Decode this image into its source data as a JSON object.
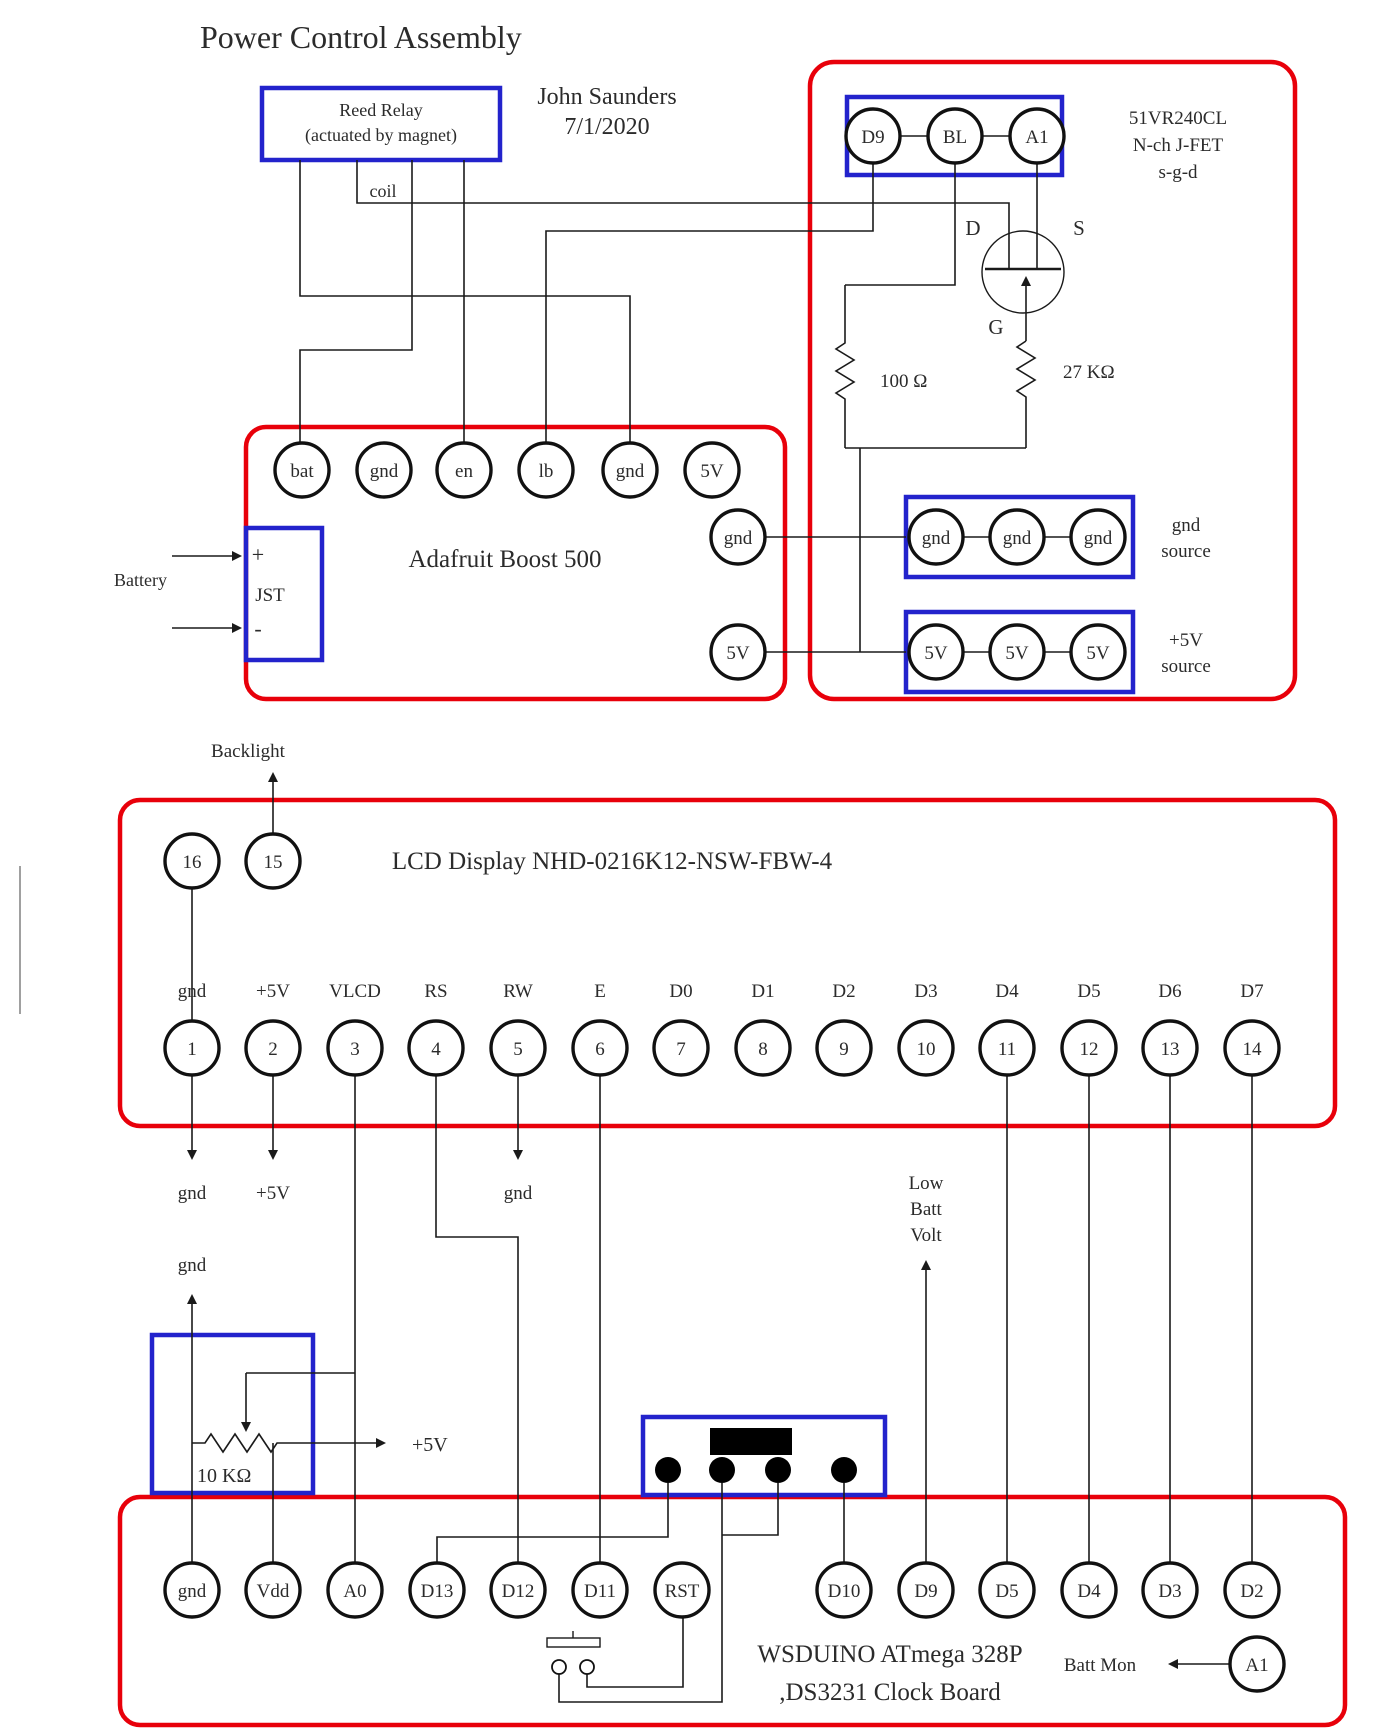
{
  "title": "Power Control Assembly",
  "author": {
    "name": "John Saunders",
    "date": "7/1/2020"
  },
  "relay": {
    "line1": "Reed Relay",
    "line2": "(actuated by magnet)",
    "coil": "coil"
  },
  "fet": {
    "header": {
      "pins": [
        "D9",
        "BL",
        "A1"
      ]
    },
    "part": "51VR240CL",
    "type": "N-ch J-FET",
    "pinout": "s-g-d",
    "d": "D",
    "s": "S",
    "g": "G",
    "r_gate": "27 KΩ",
    "r_bl": "100 Ω"
  },
  "boost": {
    "name": "Adafruit Boost 500",
    "top_pins": [
      "bat",
      "gnd",
      "en",
      "lb",
      "gnd",
      "5V"
    ],
    "right_pins": [
      "gnd",
      "5V"
    ],
    "jst": {
      "label": "JST",
      "plus": "+",
      "minus": "-"
    },
    "battery": "Battery"
  },
  "sources": {
    "gnd": {
      "pins": [
        "gnd",
        "gnd",
        "gnd"
      ],
      "label1": "gnd",
      "label2": "source"
    },
    "v5": {
      "pins": [
        "5V",
        "5V",
        "5V"
      ],
      "label1": "+5V",
      "label2": "source"
    }
  },
  "lcd": {
    "name": "LCD Display NHD-0216K12-NSW-FBW-4",
    "backlight": "Backlight",
    "top_pins": [
      "16",
      "15"
    ],
    "signals": [
      "gnd",
      "+5V",
      "VLCD",
      "RS",
      "RW",
      "E",
      "D0",
      "D1",
      "D2",
      "D3",
      "D4",
      "D5",
      "D6",
      "D7"
    ],
    "numbers": [
      "1",
      "2",
      "3",
      "4",
      "5",
      "6",
      "7",
      "8",
      "9",
      "10",
      "11",
      "12",
      "13",
      "14"
    ],
    "below": {
      "gnd1": "gnd",
      "v5": "+5V",
      "gnd2": "gnd"
    }
  },
  "pot": {
    "gnd": "gnd",
    "value": "10 KΩ",
    "v5": "+5V"
  },
  "lowbatt": {
    "l1": "Low",
    "l2": "Batt",
    "l3": "Volt"
  },
  "board": {
    "pins": [
      "gnd",
      "Vdd",
      "A0",
      "D13",
      "D12",
      "D11",
      "RST",
      "D10",
      "D9",
      "D5",
      "D4",
      "D3",
      "D2"
    ],
    "line1": "WSDUINO ATmega 328P",
    "line2": ",DS3231 Clock Board",
    "battmon": "Batt Mon",
    "a1": "A1"
  },
  "colors": {
    "wire": "#1a1a1a",
    "red": "#e8000a",
    "blue": "#2323cc",
    "text": "#2b2b2b"
  }
}
